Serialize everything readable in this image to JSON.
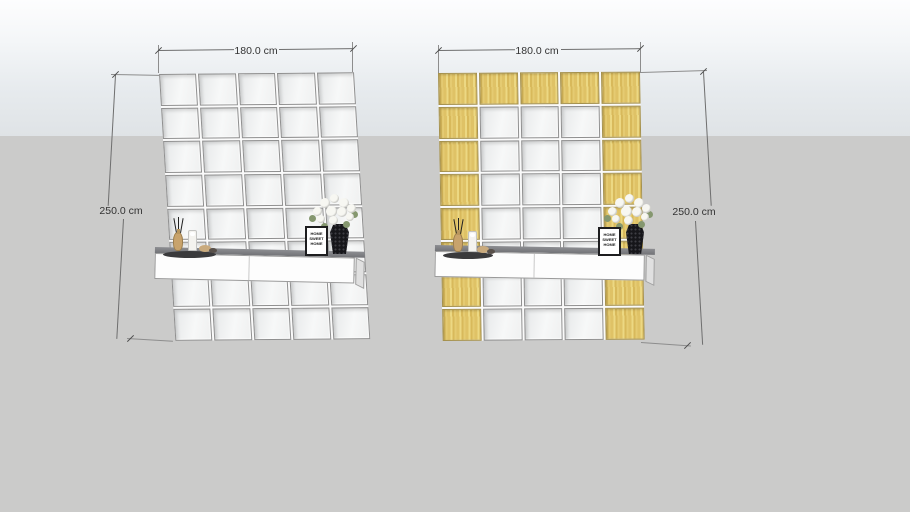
{
  "canvas": {
    "sky_top_color": "#fdfdfe",
    "sky_bottom_color": "#dfe3e6",
    "ground_color": "#cbcbca"
  },
  "walls": [
    {
      "name": "left-wall",
      "width_dimension": "180.0 cm",
      "height_dimension": "250.0 cm",
      "columns": 5,
      "rows": 8,
      "tile_rows": [
        "MMMMM",
        "MMMMM",
        "MMMMM",
        "MMMMM",
        "MMMMM",
        "MMMMM",
        "MMMMM",
        "MMMMM"
      ],
      "material_key": {
        "M": "mirror",
        "W": "wood"
      }
    },
    {
      "name": "right-wall",
      "width_dimension": "180.0 cm",
      "height_dimension": "250.0 cm",
      "columns": 5,
      "rows": 8,
      "tile_rows": [
        "WWWWW",
        "WMMMW",
        "WMMMW",
        "WMMMW",
        "WMMMW",
        "WMMMW",
        "WMMMW",
        "WMMMW"
      ],
      "material_key": {
        "M": "mirror",
        "W": "wood"
      }
    }
  ],
  "materials": {
    "mirror_tile_color": "#f2f3f3",
    "wood_tile_color": "#e0c369",
    "grout_color": "#fafafa",
    "shelf_front_color": "#fdfdfd",
    "shelf_top_color": "#7c7d81"
  },
  "decor": {
    "sign": {
      "lines": [
        "HOME",
        "SWEET",
        "HOME"
      ]
    },
    "flower_color": "#f7f7f2",
    "vase_color": "#16161a"
  }
}
